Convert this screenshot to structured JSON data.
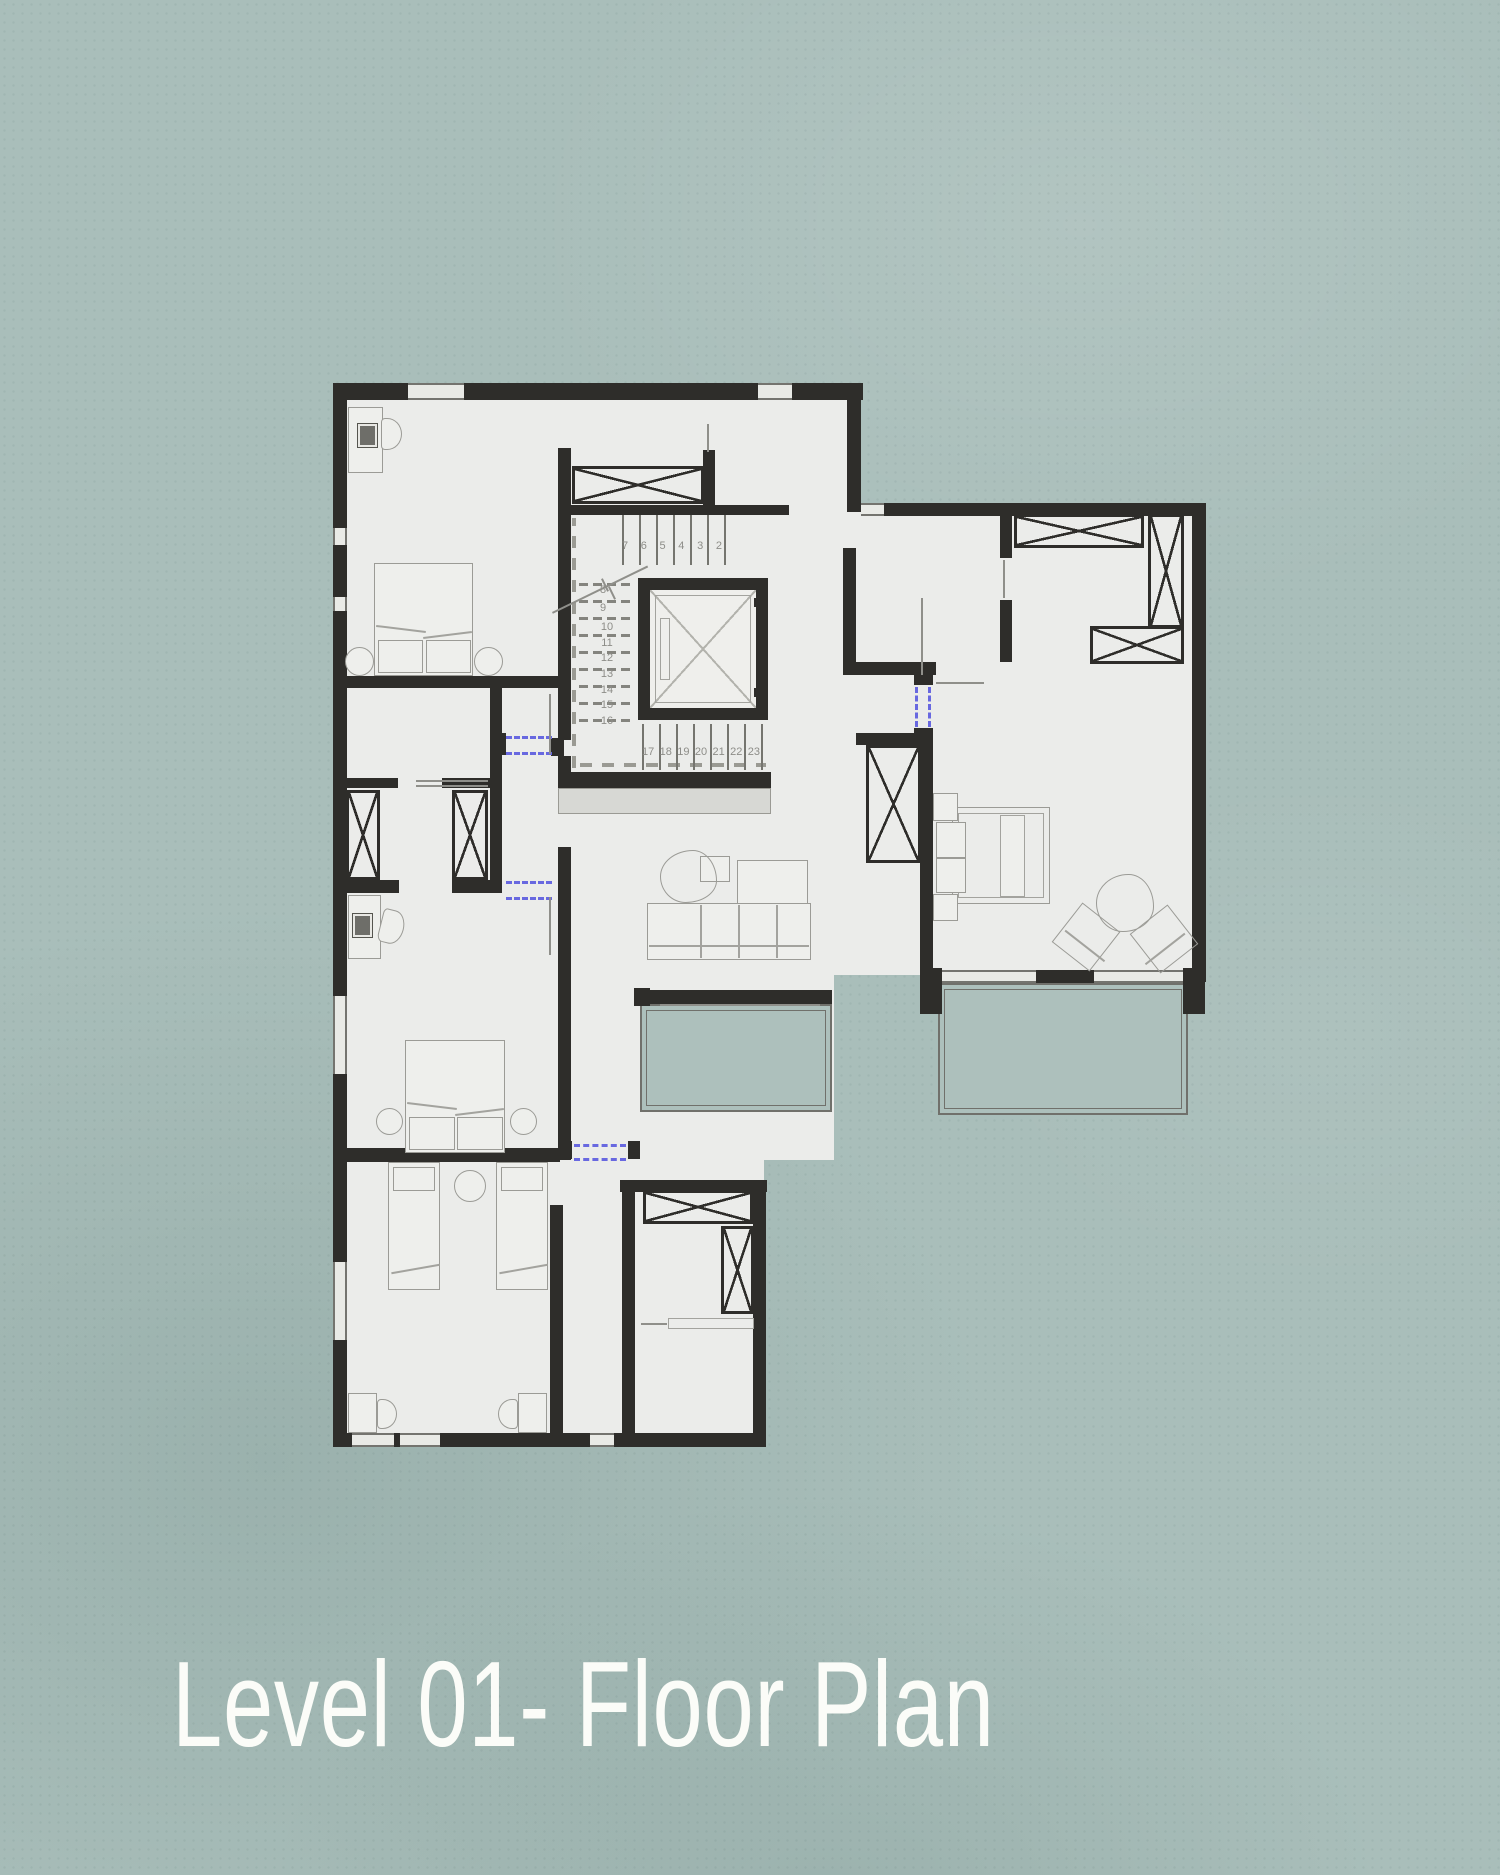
{
  "title": "Level 01- Floor Plan",
  "colors": {
    "bg": "#a9beba",
    "wall": "#2e2d2a",
    "floor": "#ebecea",
    "blue": "#6868e0",
    "line": "#8f8f8a",
    "title": "#fbfcf8",
    "balc": "#adc0bc"
  },
  "stairs": {
    "upper": [
      "7",
      "6",
      "5",
      "4",
      "3",
      "2"
    ],
    "break_numbers": [
      "8",
      "9"
    ],
    "mid": [
      "10",
      "11",
      "12",
      "13",
      "14",
      "15",
      "16"
    ],
    "lower": [
      "17",
      "18",
      "19",
      "20",
      "21",
      "22",
      "23"
    ]
  }
}
